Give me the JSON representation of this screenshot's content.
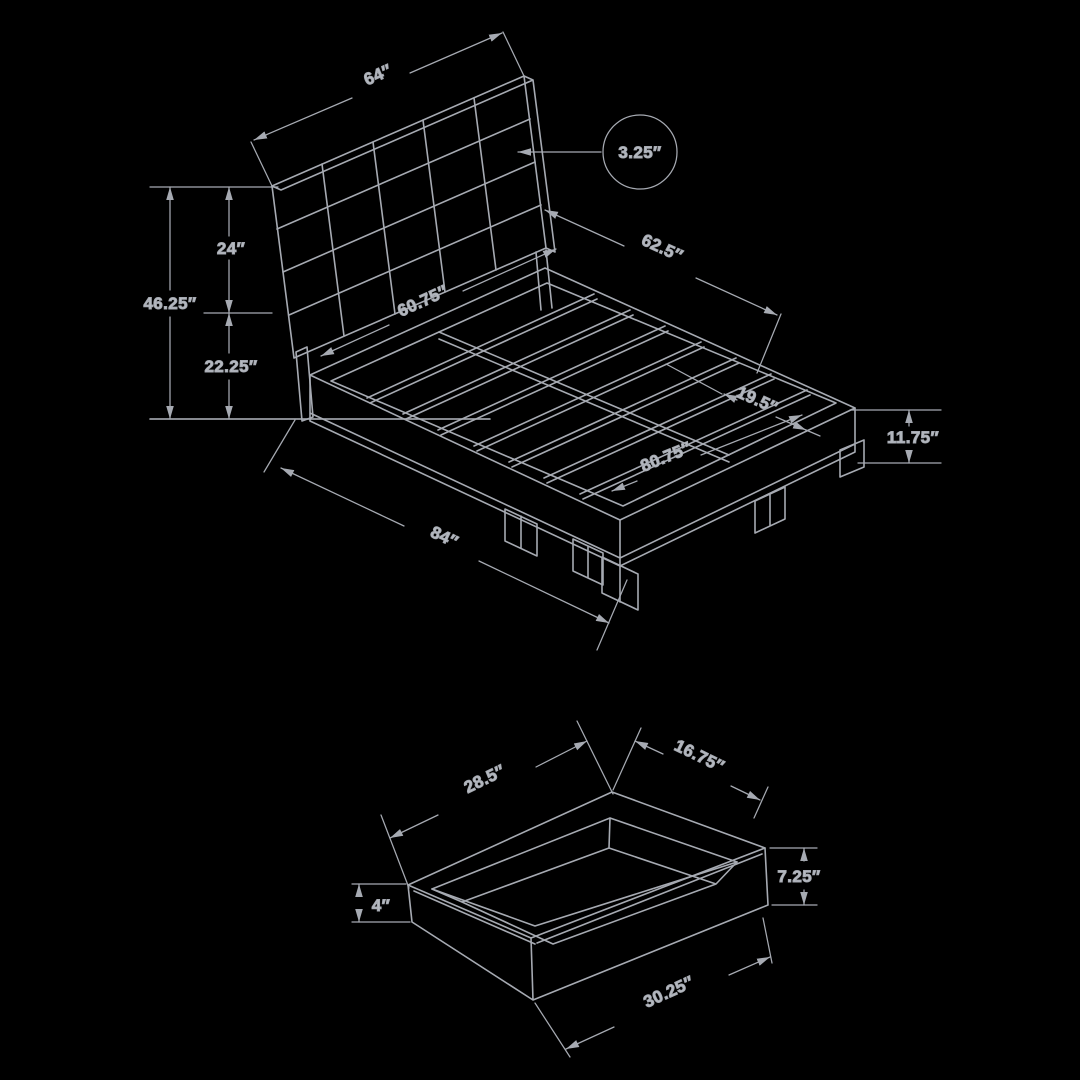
{
  "colors": {
    "background": "#000000",
    "line": "#a6aab2",
    "text": "#b7bbc2"
  },
  "bed": {
    "labels": {
      "headboard_width": "64″",
      "headboard_thickness": "3.25″",
      "headboard_panel_height": "24″",
      "total_height": "46.25″",
      "base_height": "22.25″",
      "deck_width": "62.5″",
      "slat_area_width": "60.75″",
      "foot_deck_depth": "19.5″",
      "interior_length": "80.75″",
      "overall_length": "84″",
      "rail_height": "11.75″"
    }
  },
  "drawer": {
    "labels": {
      "inner_width": "28.5″",
      "inner_depth": "16.75″",
      "side_height": "7.25″",
      "front_height": "4″",
      "outer_length": "30.25″"
    }
  }
}
